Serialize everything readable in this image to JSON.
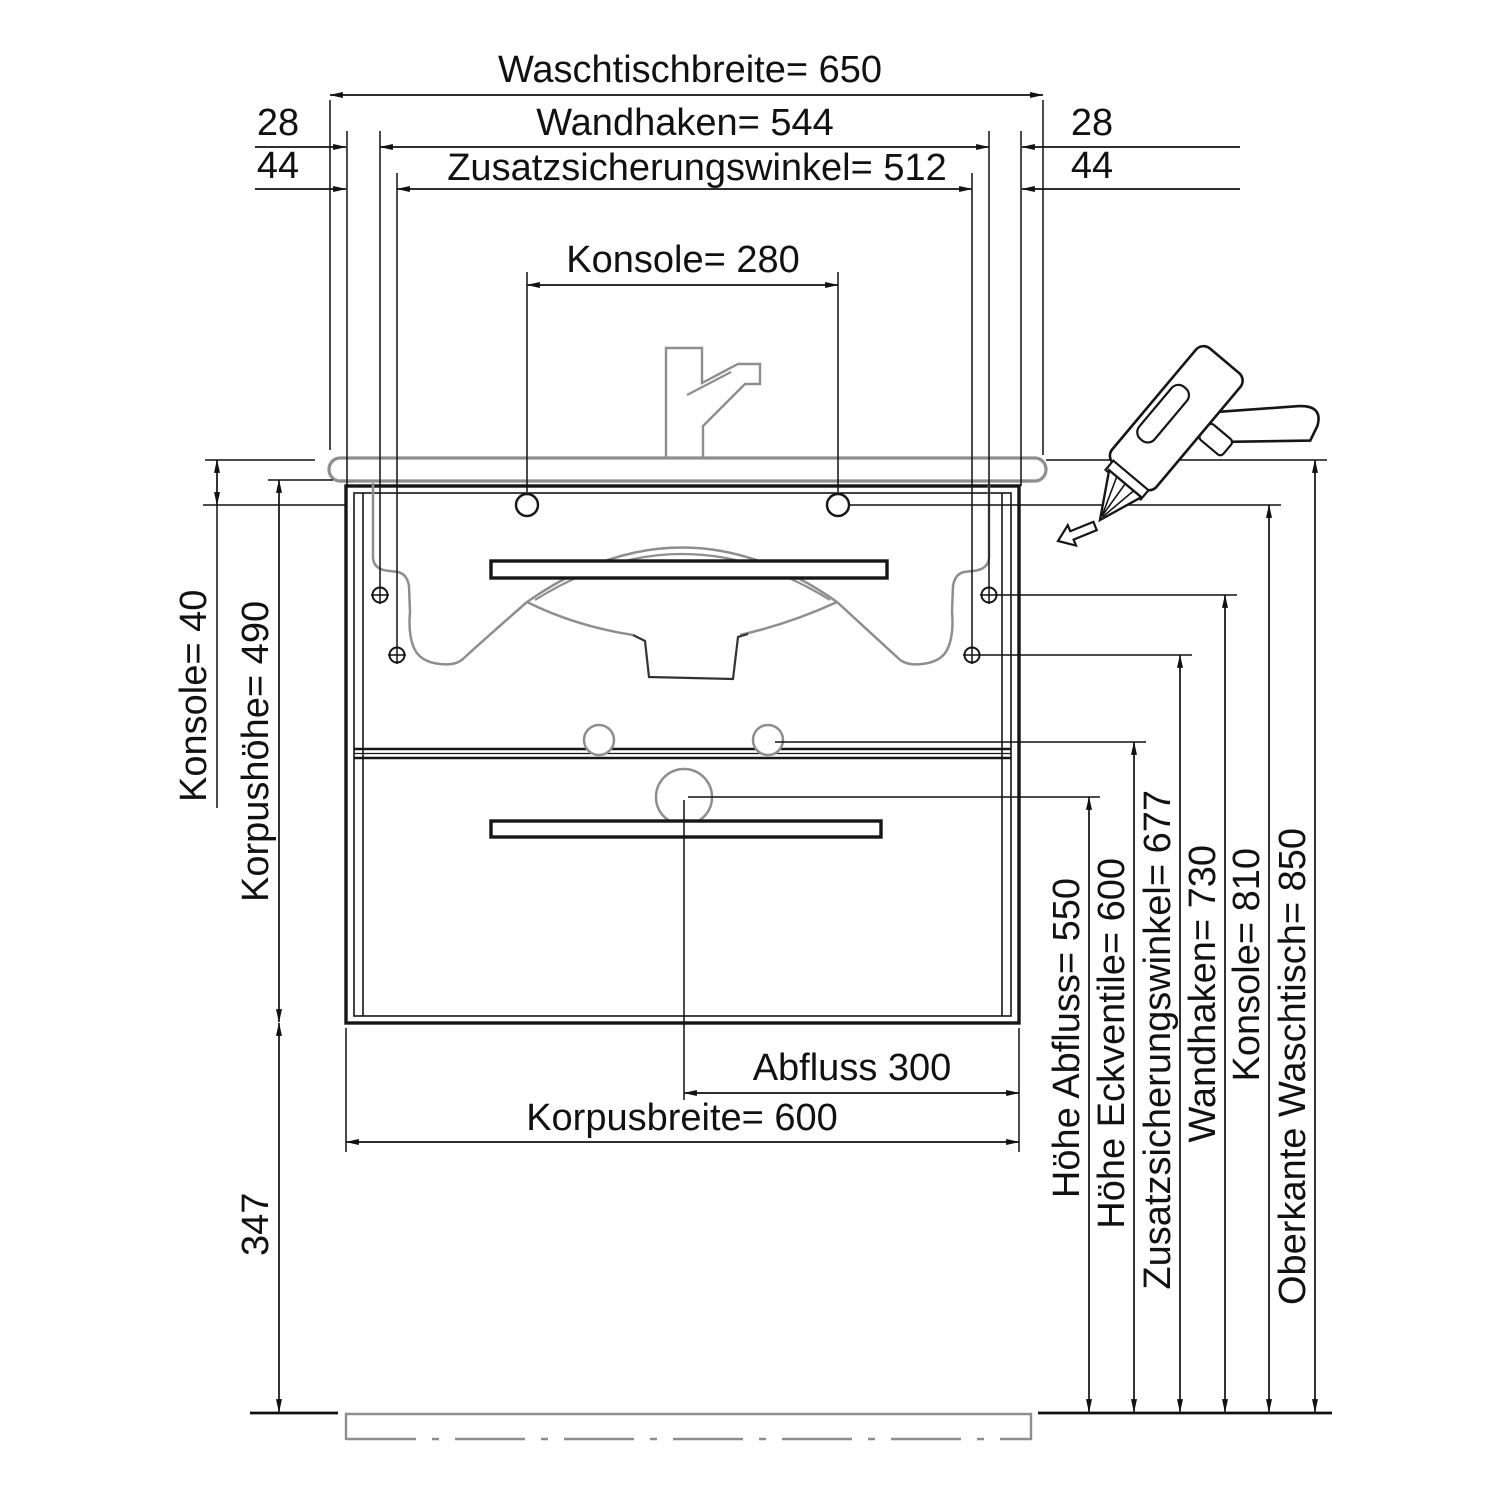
{
  "drawing": {
    "background": "#ffffff",
    "line_color": "#111111",
    "sanitary_line_color": "#8e8e8e"
  },
  "dims": {
    "waschtischbreite": {
      "label": "Waschtischbreite= 650",
      "value": 650
    },
    "wandhaken_top": {
      "label": "Wandhaken= 544",
      "value": 544
    },
    "zusatzwinkel_top": {
      "label": "Zusatzsicherungswinkel= 512",
      "value": 512
    },
    "offset_28": {
      "label": "28",
      "value": 28
    },
    "offset_44": {
      "label": "44",
      "value": 44
    },
    "konsole_width": {
      "label": "Konsole= 280",
      "value": 280
    },
    "konsole_offset": {
      "label": "Konsole= 40",
      "value": 40
    },
    "korpushoehe": {
      "label": "Korpushöhe= 490",
      "value": 490
    },
    "bodenabstand": {
      "label": "347",
      "value": 347
    },
    "abfluss_width": {
      "label": "Abfluss 300",
      "value": 300
    },
    "korpusbreite": {
      "label": "Korpusbreite= 600",
      "value": 600
    },
    "hoehe_abfluss": {
      "label": "Höhe Abfluss= 550",
      "value": 550
    },
    "hoehe_eckventile": {
      "label": "Höhe Eckventile= 600",
      "value": 600
    },
    "zusatzwinkel_height": {
      "label": "Zusatzsicherungswinkel= 677",
      "value": 677
    },
    "wandhaken_height": {
      "label": "Wandhaken= 730",
      "value": 730
    },
    "konsole_height": {
      "label": "Konsole= 810",
      "value": 810
    },
    "oberkante_waschtisch": {
      "label": "Oberkante Waschtisch= 850",
      "value": 850
    }
  },
  "icons": {
    "glue_gun": "glue-gun-icon",
    "direction_arrow": "direction-arrow-icon"
  }
}
